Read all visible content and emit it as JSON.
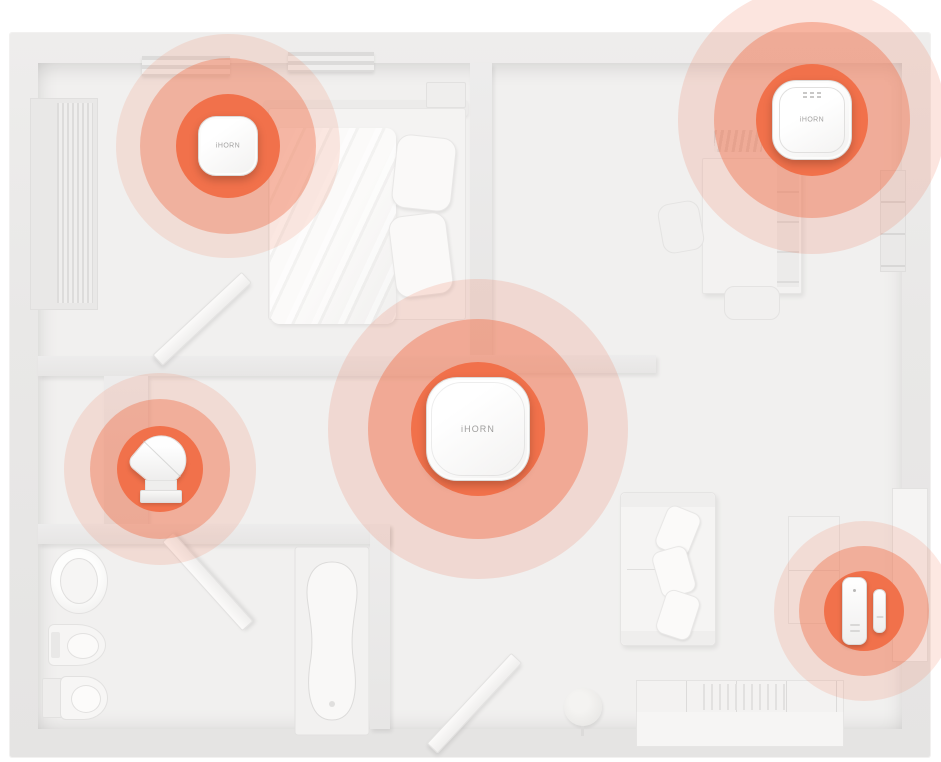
{
  "meta": {
    "scene": "smart-home-security-floorplan-top-view",
    "accent_color": "#F1714B",
    "wall_color": "#E9E8E7",
    "floor_color": "#F1F0EF"
  },
  "devices": [
    {
      "id": "smoke-detector-bedroom",
      "type": "detector",
      "label": "iHORN",
      "x": 228,
      "y": 146,
      "size": 60,
      "rings": [
        {
          "r": 52,
          "alpha": 1
        },
        {
          "r": 88,
          "alpha": 0.4
        },
        {
          "r": 112,
          "alpha": 0.15
        }
      ]
    },
    {
      "id": "smoke-detector-study",
      "type": "detector-bezel",
      "label": "iHORN",
      "x": 812,
      "y": 120,
      "size": 80,
      "rings": [
        {
          "r": 56,
          "alpha": 1
        },
        {
          "r": 98,
          "alpha": 0.42
        },
        {
          "r": 134,
          "alpha": 0.18
        }
      ]
    },
    {
      "id": "alarm-hub-central",
      "type": "hub",
      "label": "iHORN",
      "x": 478,
      "y": 429,
      "size": 104,
      "rings": [
        {
          "r": 67,
          "alpha": 1
        },
        {
          "r": 110,
          "alpha": 0.45
        },
        {
          "r": 150,
          "alpha": 0.18
        }
      ]
    },
    {
      "id": "air-duct-detector",
      "type": "duct",
      "label": "",
      "x": 160,
      "y": 469,
      "size": 64,
      "rings": [
        {
          "r": 43,
          "alpha": 1
        },
        {
          "r": 70,
          "alpha": 0.42
        },
        {
          "r": 96,
          "alpha": 0.16
        }
      ]
    },
    {
      "id": "door-window-sensor",
      "type": "door-sensor",
      "label": "",
      "x": 864,
      "y": 611,
      "size": 70,
      "rings": [
        {
          "r": 40,
          "alpha": 1
        },
        {
          "r": 65,
          "alpha": 0.42
        },
        {
          "r": 90,
          "alpha": 0.16
        }
      ]
    }
  ]
}
